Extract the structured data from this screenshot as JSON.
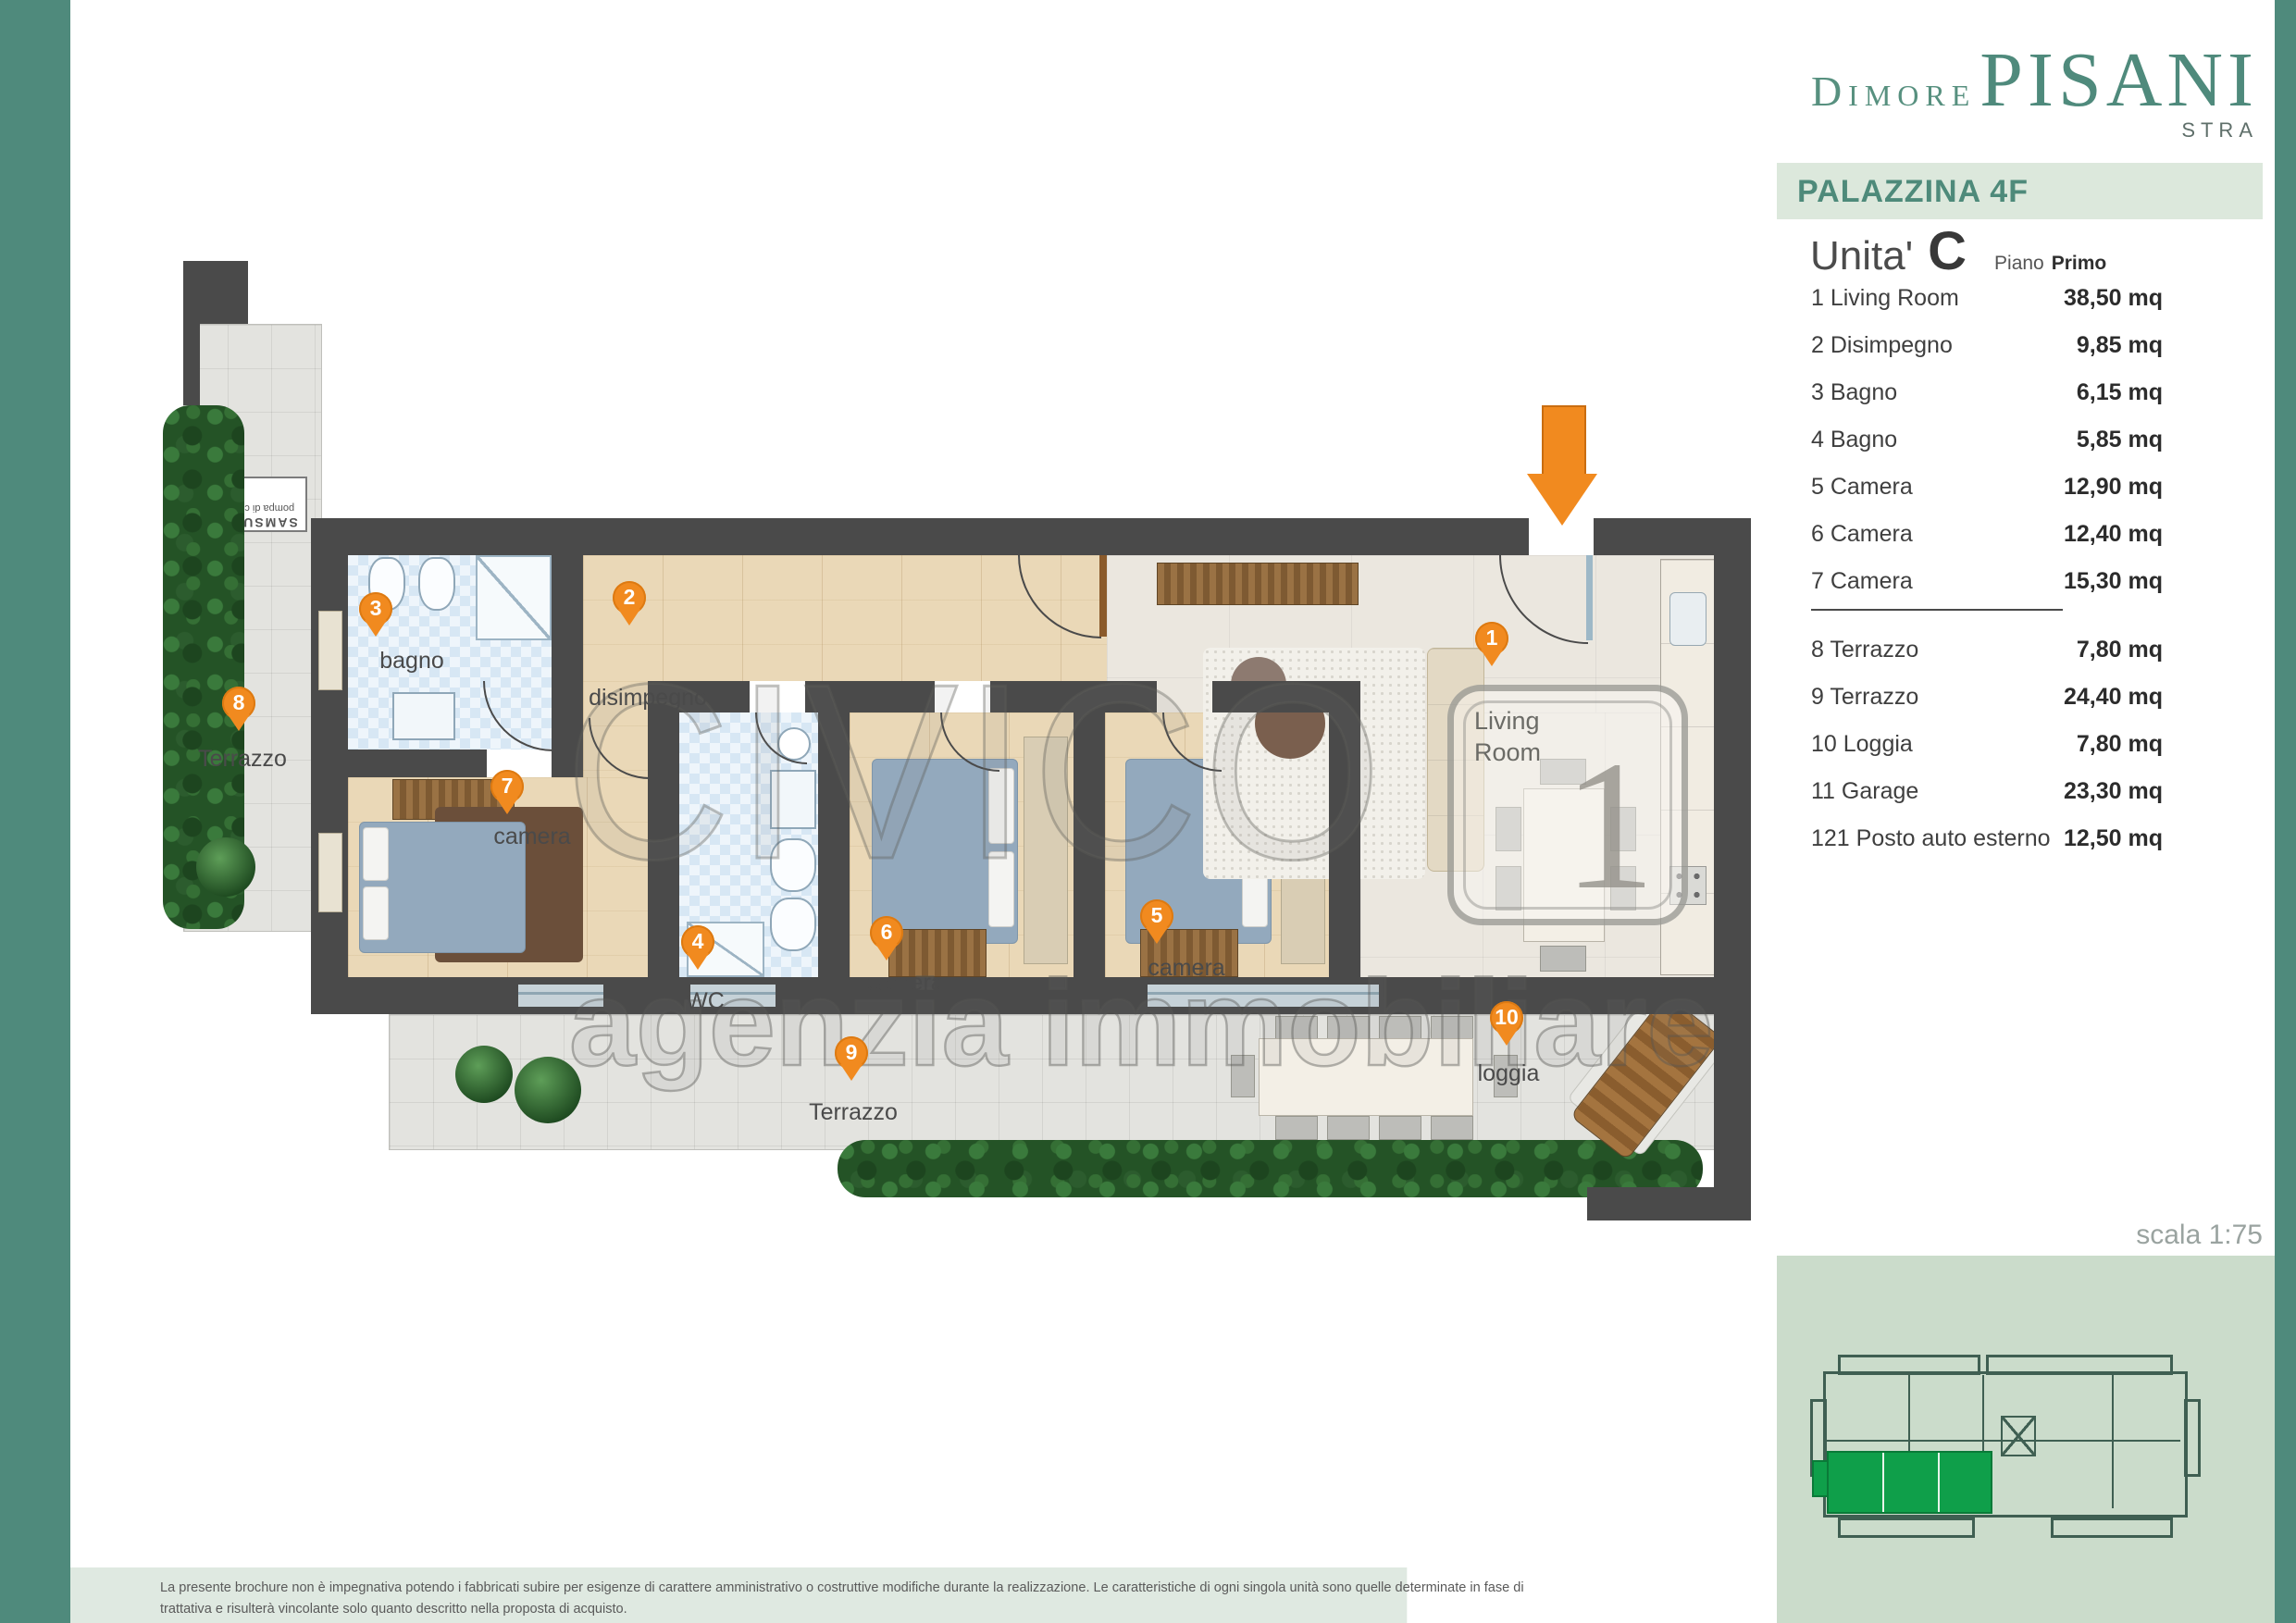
{
  "brand": {
    "small": "Dimore",
    "large": "PISANI",
    "city": "STRA"
  },
  "header": {
    "building": "PALAZZINA 4F",
    "unit_label": "Unita'",
    "unit_letter": "C",
    "floor_label": "Piano",
    "floor_value": "Primo"
  },
  "rooms": [
    {
      "n": "1",
      "name": "1 Living Room",
      "area": "38,50 mq"
    },
    {
      "n": "2",
      "name": "2 Disimpegno",
      "area": "9,85 mq"
    },
    {
      "n": "3",
      "name": "3 Bagno",
      "area": "6,15 mq"
    },
    {
      "n": "4",
      "name": "4 Bagno",
      "area": "5,85 mq"
    },
    {
      "n": "5",
      "name": "5 Camera",
      "area": "12,90 mq"
    },
    {
      "n": "6",
      "name": "6 Camera",
      "area": "12,40 mq"
    },
    {
      "n": "7",
      "name": "7 Camera",
      "area": "15,30 mq"
    },
    {
      "n": "8",
      "name": "8 Terrazzo",
      "area": "7,80 mq"
    },
    {
      "n": "9",
      "name": "9 Terrazzo",
      "area": "24,40 mq"
    },
    {
      "n": "10",
      "name": "10 Loggia",
      "area": "7,80 mq"
    },
    {
      "n": "11",
      "name": "11 Garage",
      "area": "23,30 mq"
    },
    {
      "n": "121",
      "name": "121 Posto auto esterno",
      "area": "12,50 mq"
    }
  ],
  "scale_note": "scala 1:75",
  "plan": {
    "labels": {
      "terrazzo": "Terrazzo",
      "bagno": "bagno",
      "disimpegno": "disimpegno",
      "camera": "camera",
      "wc": "WC",
      "loggia": "loggia",
      "living1": "Living",
      "living2": "Room",
      "big_one": "1",
      "heatpump1": "SAMSUNG",
      "heatpump2": "pompa di calore"
    },
    "pins": {
      "living": "1",
      "disimpegno": "2",
      "bagno": "3",
      "wc": "4",
      "camera5": "5",
      "camera6": "6",
      "camera7": "7",
      "terrazzo8": "8",
      "terrazzo9": "9",
      "loggia": "10"
    }
  },
  "watermark": {
    "line1": "CIVICO",
    "line2": "agenzia immobiliare"
  },
  "disclaimer": {
    "line1": "La presente brochure non è impegnativa potendo i fabbricati subire per esigenze di carattere amministrativo o costruttive modifiche durante la realizzazione. Le caratteristiche di ogni singola unità sono quelle determinate in fase di",
    "line2": "trattativa e risulterà vincolante solo quanto descritto nella proposta di acquisto."
  },
  "colors": {
    "accent_teal": "#4F8A7C",
    "band_bg": "#DCE8DC",
    "panel_bg": "#CBDCCB",
    "pin_orange": "#F18A1F",
    "highlight_green": "#0F9F4A",
    "wall_gray": "#4A4A4A"
  }
}
